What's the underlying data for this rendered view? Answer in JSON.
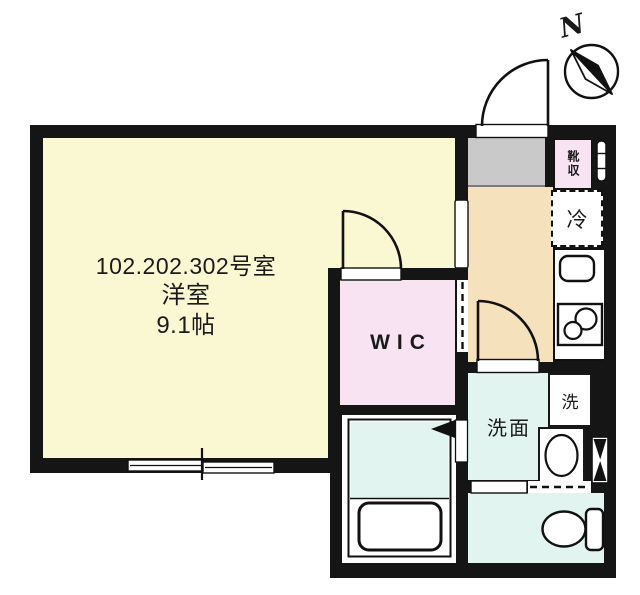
{
  "plan": {
    "unit_label": "102.202.302号室",
    "room_type_label": "洋室",
    "room_size_label": "9.1帖",
    "wic_label": "WIC",
    "shoe_storage_label": "靴収",
    "refrigerator_label": "冷",
    "washroom_label": "洗面",
    "laundry_label": "洗",
    "compass_north_label": "N",
    "colors": {
      "wall": "#151515",
      "main_room": "#faf8d3",
      "wic": "#f8e3f3",
      "shoe_storage": "#f8e3f3",
      "kitchen": "#f5e2bc",
      "entry": "#c9c9c9",
      "wet_rooms": "#e1f4f0",
      "fixture_outline": "#111111"
    }
  }
}
